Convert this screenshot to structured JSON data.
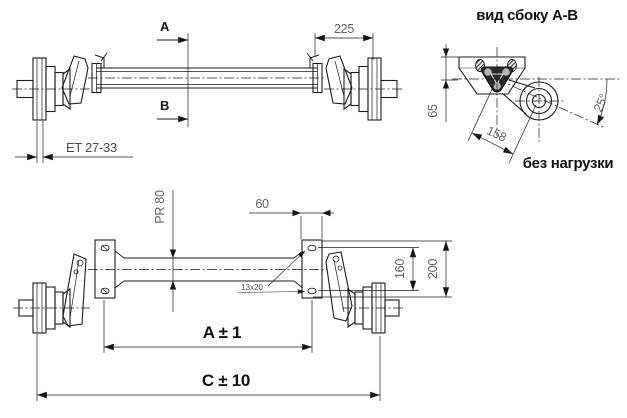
{
  "front_view": {
    "section_arrow_top": "A",
    "section_arrow_bottom": "B",
    "dim_hub_offset": "ET 27-33",
    "dim_brake_width": "225"
  },
  "side_view": {
    "title": "вид сбоку A-B",
    "dim_bracket_height": "65",
    "dim_arm_length": "158",
    "dim_arm_angle": "25°",
    "note": "без нагрузки"
  },
  "plan_view": {
    "dim_tube_profile": "PR 80",
    "dim_plate_width": "60",
    "slot_label": "13x20",
    "dim_hole_spacing": "160",
    "dim_plate_height": "200",
    "dim_mounting_span": "A ± 1",
    "dim_overall_length": "C ± 10"
  },
  "colors": {
    "background": "#ffffff",
    "line": "#1c1c1c",
    "dim_text": "#5f5f5f",
    "label_text": "#111111"
  }
}
